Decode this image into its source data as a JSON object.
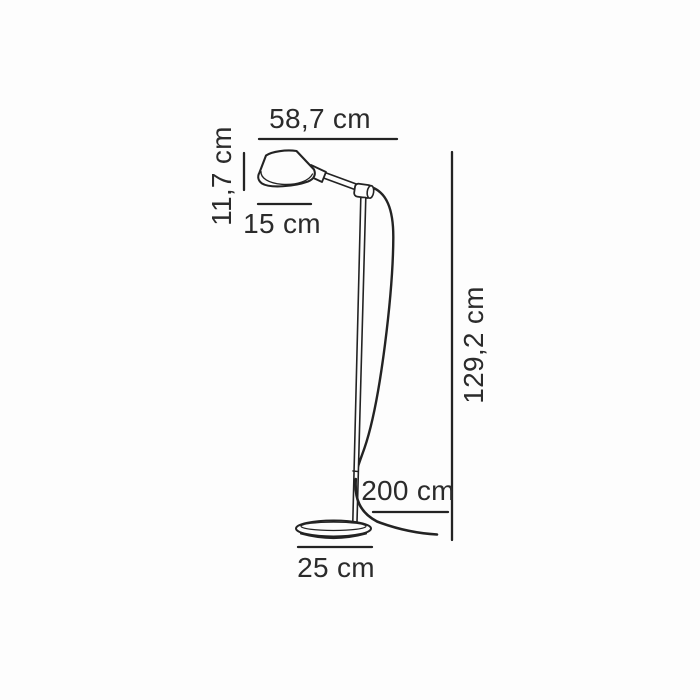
{
  "figure": {
    "labels": {
      "width": "58,7 cm",
      "head_height": "11,7 cm",
      "head_depth": "15 cm",
      "total_height": "129,2 cm",
      "cable_length": "200 cm",
      "base_diameter": "25 cm"
    },
    "colors": {
      "background": "#fdfdfd",
      "line": "#232323",
      "text": "#2b2b2b"
    }
  }
}
